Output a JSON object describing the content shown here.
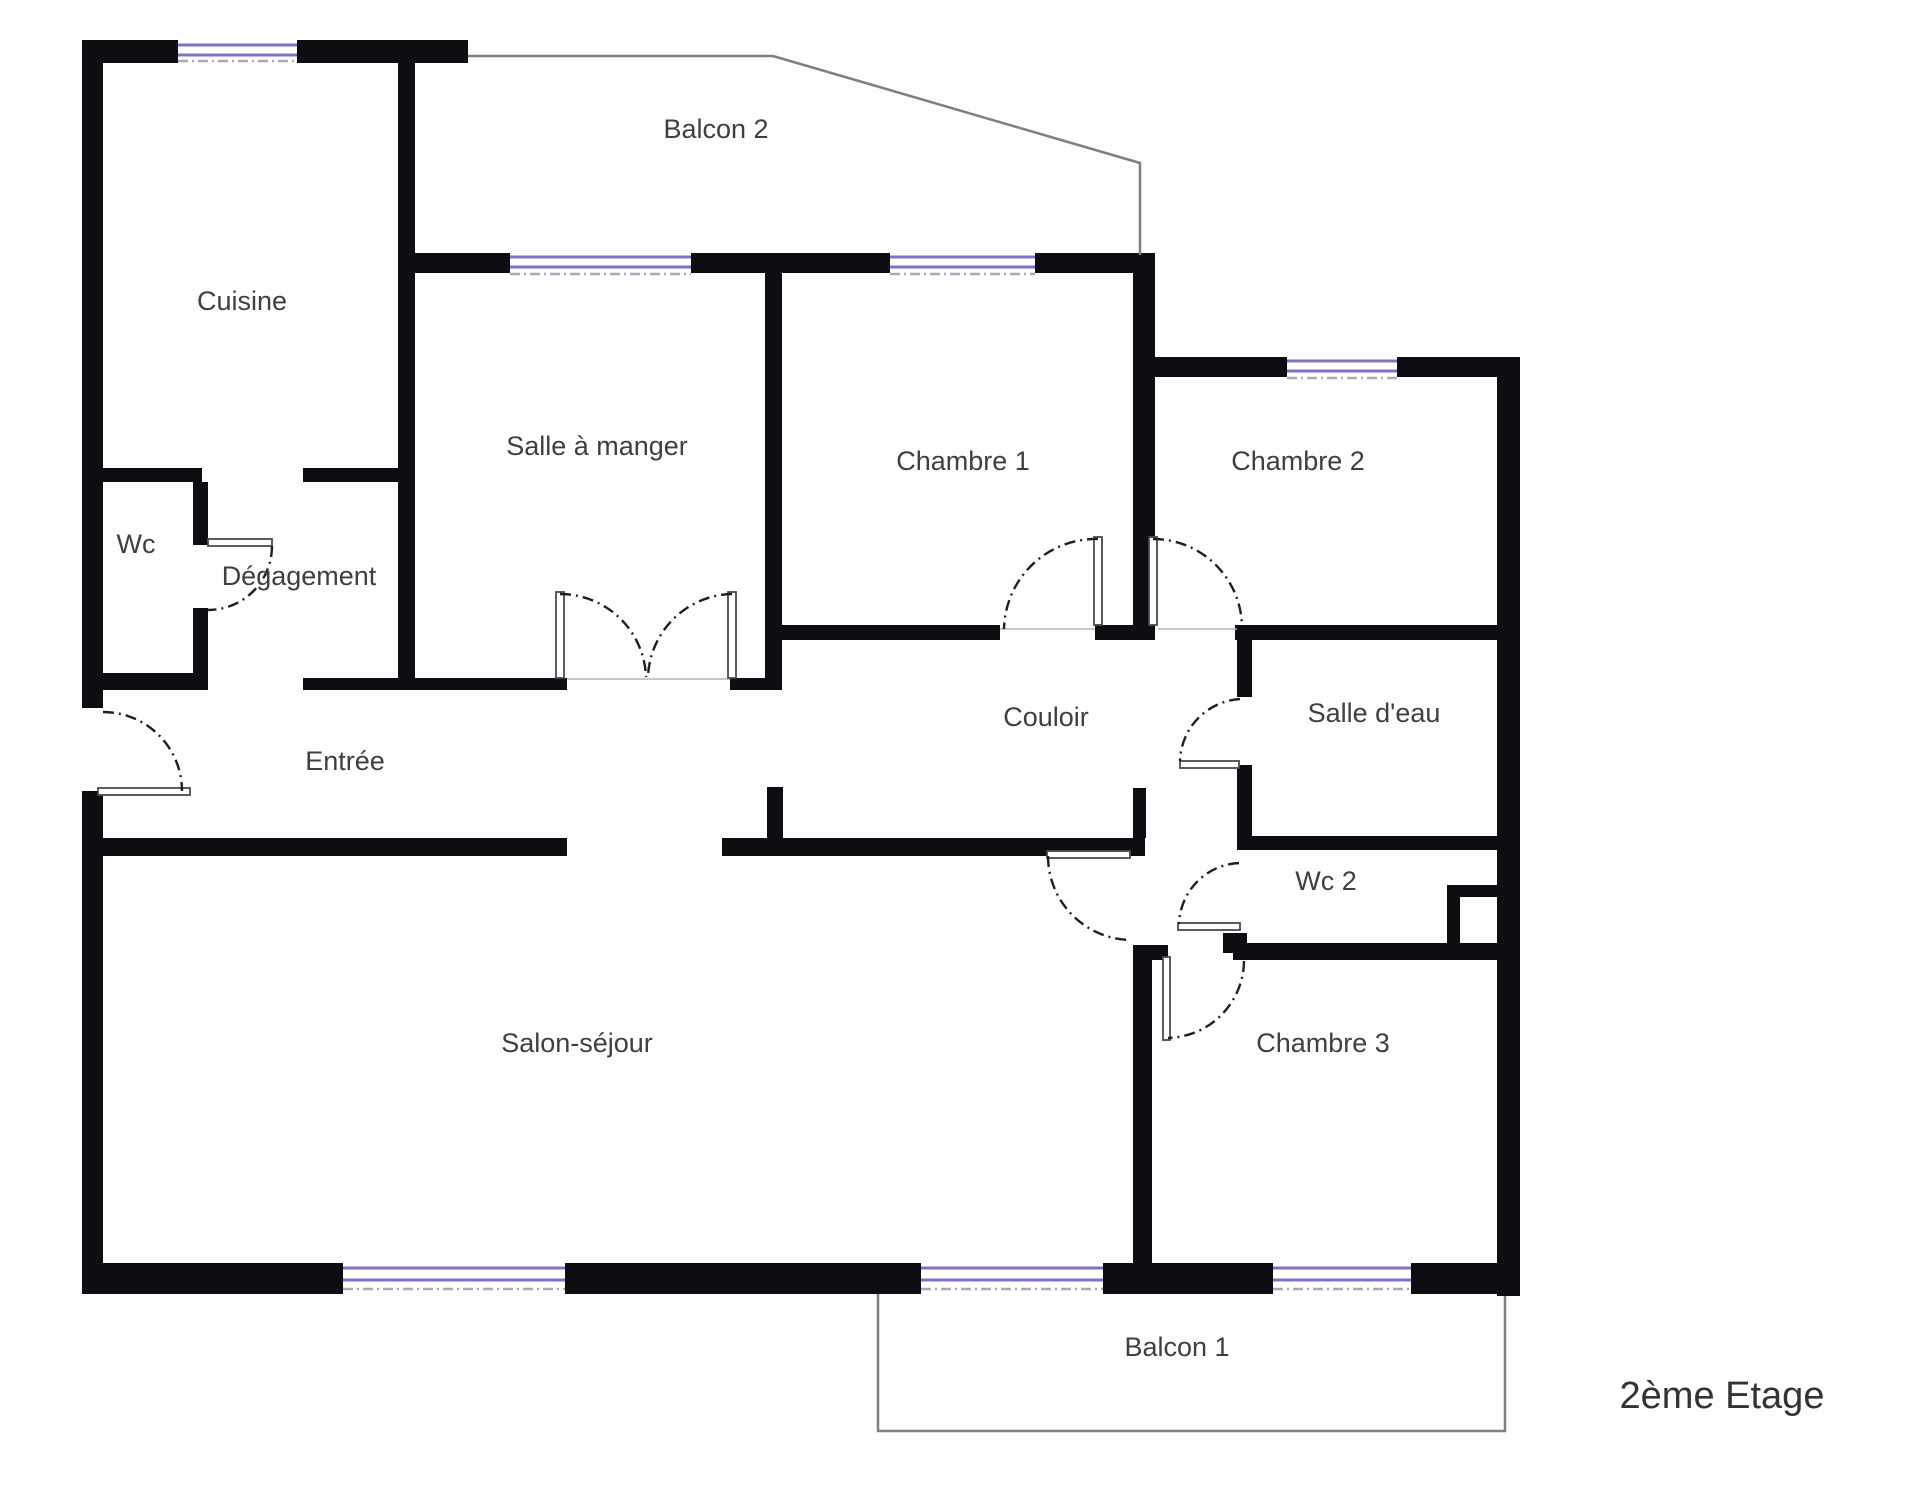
{
  "title": "Plan d'appartement",
  "floor_label": "2ème Etage",
  "rooms": {
    "cuisine": "Cuisine",
    "balcon2": "Balcon 2",
    "salle_a_manger": "Salle à manger",
    "chambre1": "Chambre 1",
    "chambre2": "Chambre 2",
    "wc": "Wc",
    "degagement": "Dégagement",
    "entree": "Entrée",
    "couloir": "Couloir",
    "salle_deau": "Salle d'eau",
    "wc2": "Wc 2",
    "salon": "Salon-séjour",
    "chambre3": "Chambre 3",
    "balcon1": "Balcon 1"
  },
  "colors": {
    "wall": "#0e0d11",
    "window": "#7b73c7",
    "balcony_line": "#7f7f7f",
    "door_leaf": "#4a4a4a",
    "door_arc": "#1f1f1f",
    "window_dash": "#a9a9bd",
    "text": "#3f3f3f",
    "background": "#fdfdfd"
  }
}
